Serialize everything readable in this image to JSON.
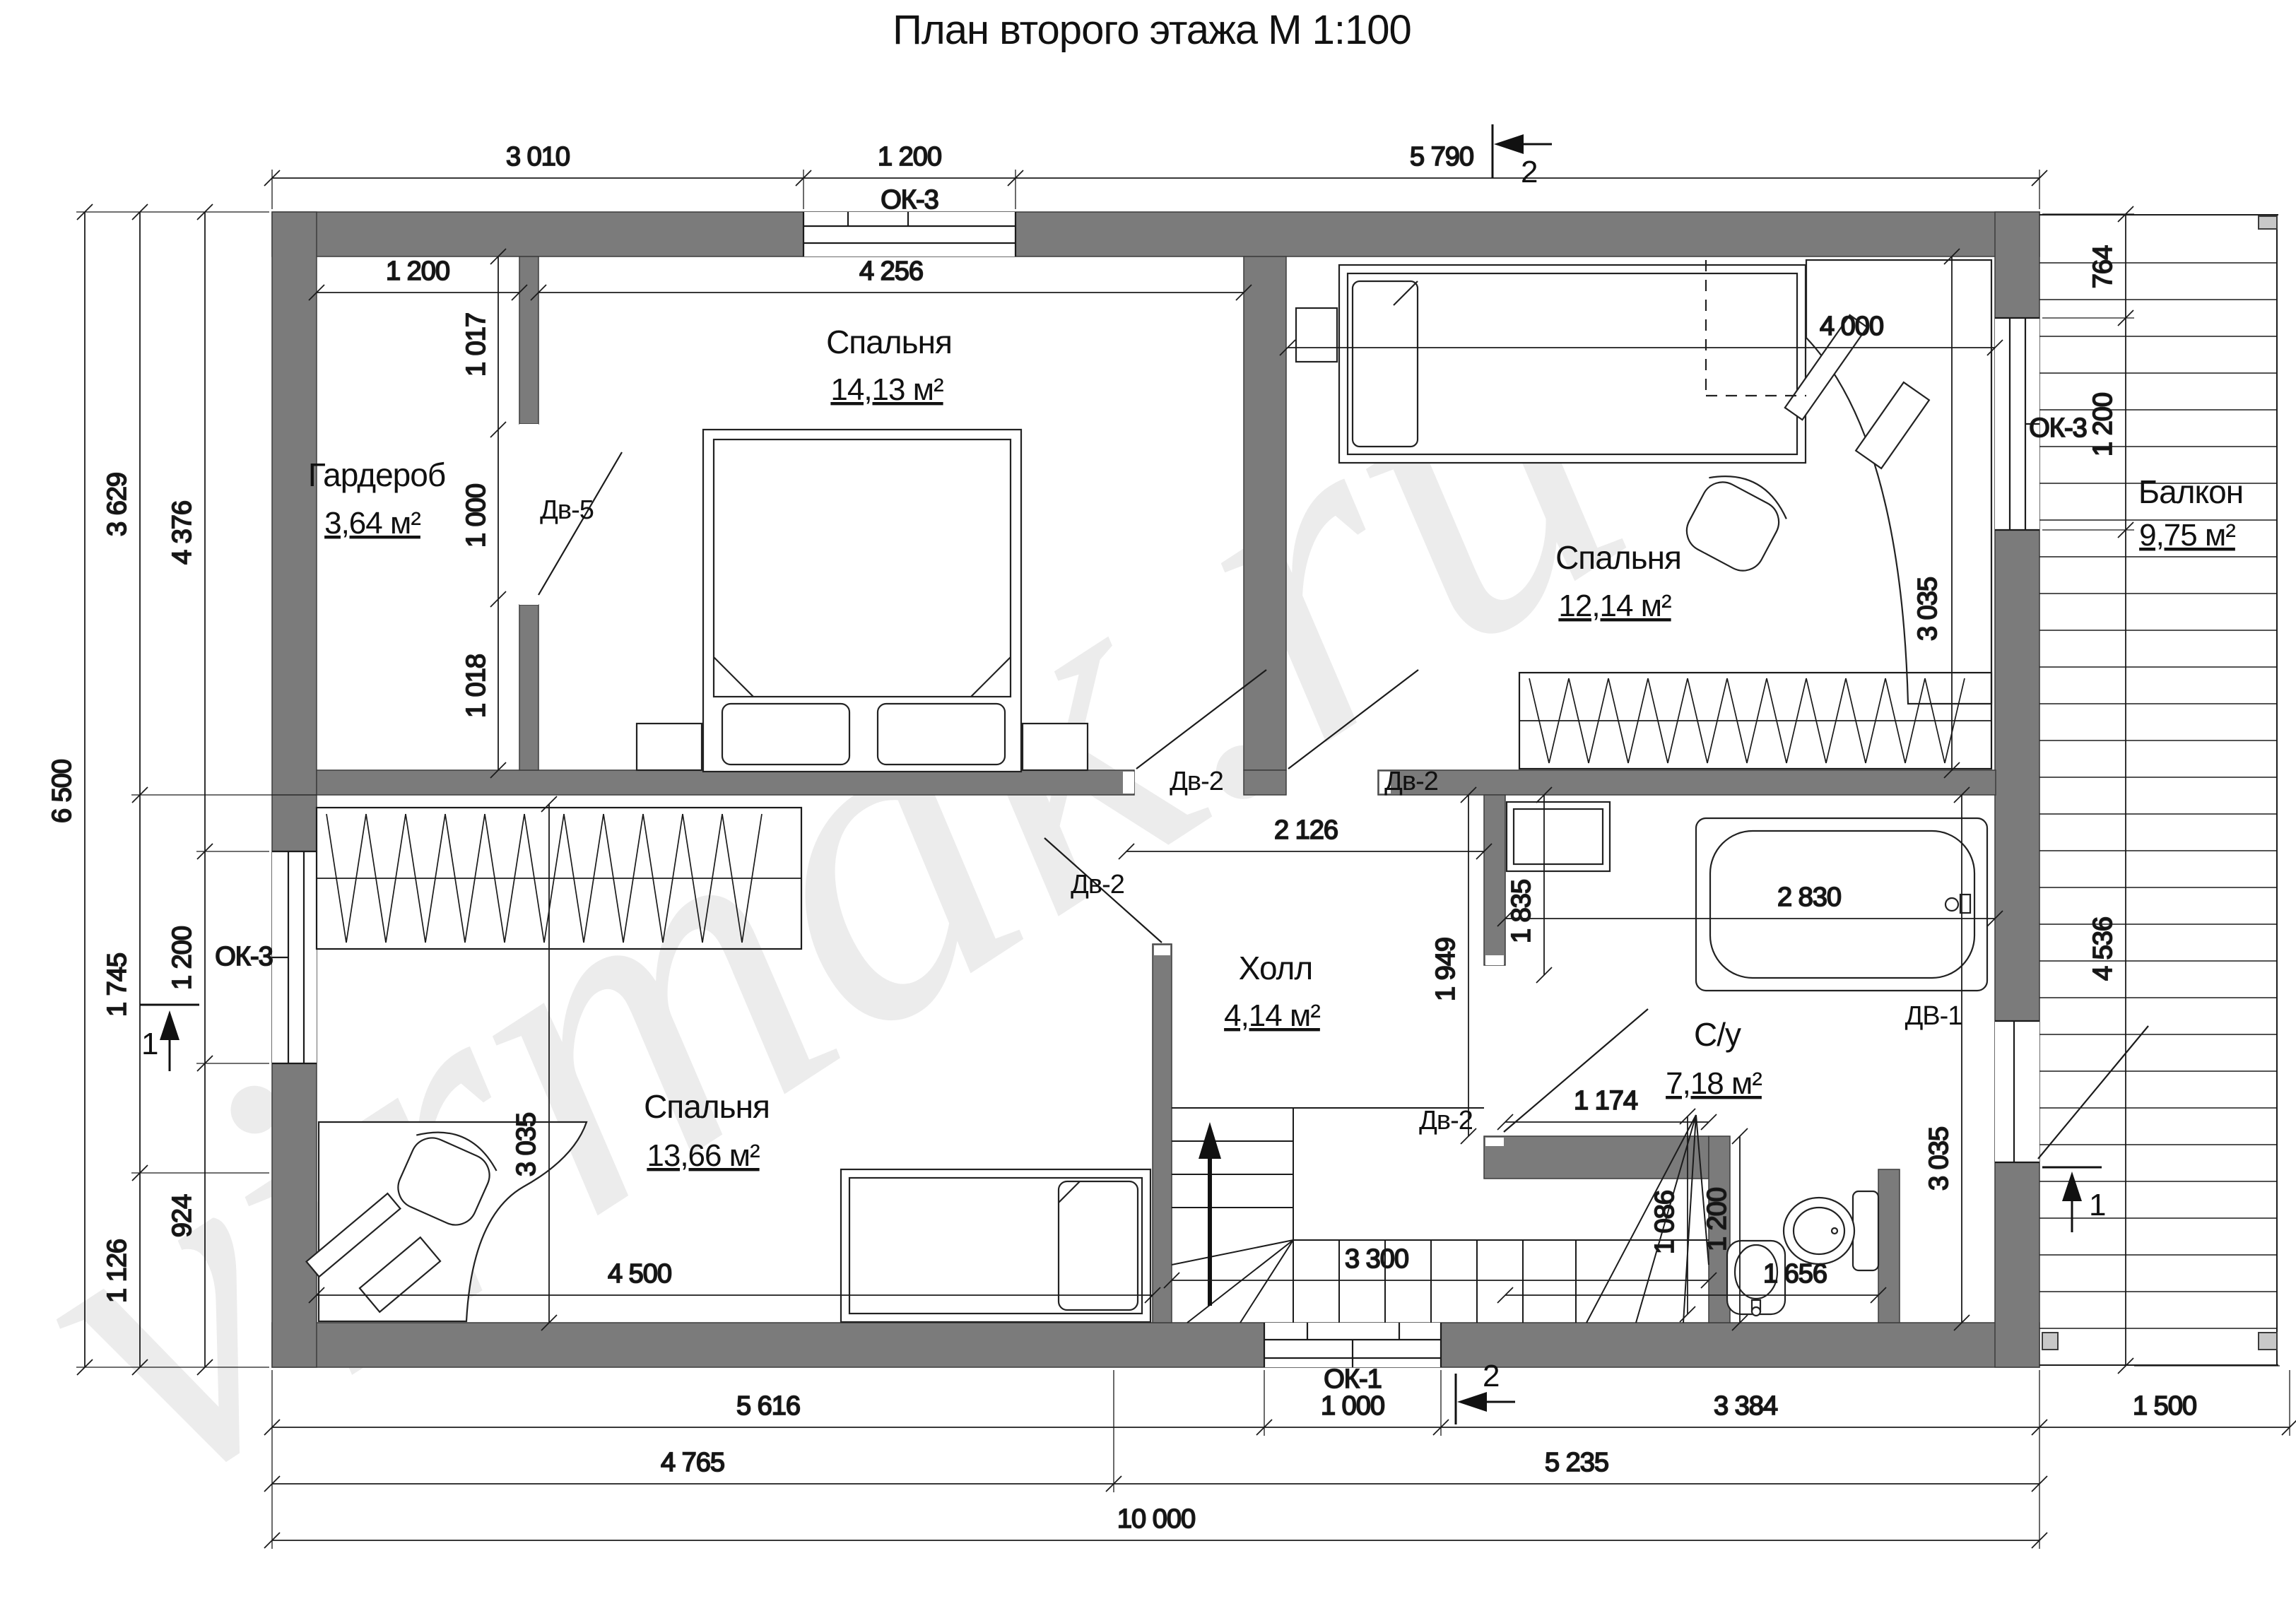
{
  "title": "План второго этажа М 1:100",
  "watermark": "virmak.ru",
  "rooms": {
    "garderob": {
      "name": "Гардероб",
      "area": "3,64 м²"
    },
    "bedroom_top": {
      "name": "Спальня",
      "area": "14,13 м²"
    },
    "bedroom_right": {
      "name": "Спальня",
      "area": "12,14 м²"
    },
    "bedroom_bottom": {
      "name": "Спальня",
      "area": "13,66 м²"
    },
    "hall": {
      "name": "Холл",
      "area": "4,14 м²"
    },
    "bathroom": {
      "name": "С/у",
      "area": "7,18 м²"
    },
    "balcony": {
      "name": "Балкон",
      "area": "9,75 м²"
    }
  },
  "doors": {
    "dv5": "Дв-5",
    "dv2": "Дв-2",
    "dv1": "ДВ-1"
  },
  "windows": {
    "ok3": "ОК-3",
    "ok1": "ОК-1"
  },
  "sections": {
    "s1": "1",
    "s2": "2"
  },
  "dims": {
    "top_3010": "3 010",
    "top_1200": "1 200",
    "top_5790": "5 790",
    "in_1200": "1 200",
    "in_4256": "4 256",
    "in_4000": "4 000",
    "left_6500": "6 500",
    "left_3629": "3 629",
    "left_1745": "1 745",
    "left_1126": "1 126",
    "left_4376": "4 376",
    "left_1200": "1 200",
    "left_924": "924",
    "gard_1017": "1 017",
    "gard_1000": "1 000",
    "gard_1018": "1 018",
    "right_764": "764",
    "right_1200": "1 200",
    "right_4536": "4 536",
    "b2_3035": "3 035",
    "b3_3035": "3 035",
    "b3_4500": "4 500",
    "hall_2126": "2 126",
    "hall_1949": "1 949",
    "bath_1835": "1 835",
    "bath_2830": "2 830",
    "bath_1174": "1 174",
    "bath_3035": "3 035",
    "bath_1200": "1 200",
    "bath_1656": "1 656",
    "st_3300": "3 300",
    "st_1086": "1 086",
    "bot_5616": "5 616",
    "bot_1000": "1 000",
    "bot_3384": "3 384",
    "bot_1500": "1 500",
    "bot_4765": "4 765",
    "bot_5235": "5 235",
    "bot_10000": "10 000"
  }
}
